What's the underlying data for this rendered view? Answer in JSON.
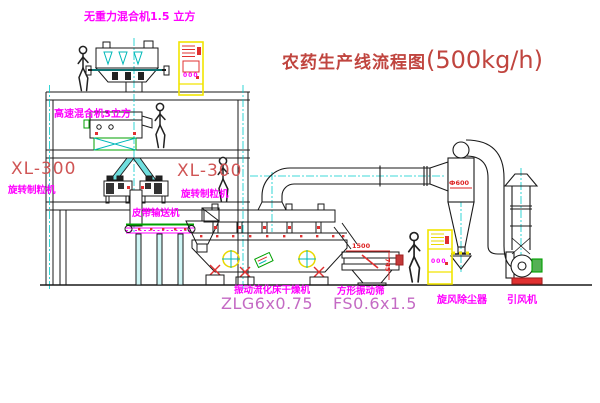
{
  "title": {
    "text": "农药生产线流程图",
    "capacity": "(500kg/h)",
    "color": "#c0453f"
  },
  "equipment_labels": {
    "gravity_mixer": "无重力混合机1.5 立方",
    "highspeed_mixer": "高速混合机3立方",
    "granulator_left_model": "XL-300",
    "granulator_left_name": "旋转制粒机",
    "granulator_right_model": "XL-300",
    "granulator_right_name": "旋转制粒机",
    "belt_conveyor": "皮带输送机",
    "fluid_bed_dryer": "振动流化床干燥机",
    "fluid_bed_dryer_model": "ZLG6x0.75",
    "vibrating_screen": "方形振动筛",
    "vibrating_screen_model": "FS0.6x1.5",
    "cyclone": "旋风除尘器",
    "induced_draft_fan": "引风机"
  },
  "dimensions": {
    "screen_length": "1500",
    "screen_height": "745",
    "cyclone_diameter": "Ф600"
  },
  "control_cabinets": [
    {
      "mark": "000"
    },
    {
      "mark": "000"
    }
  ],
  "colors": {
    "label_magenta": "#ff00ff",
    "model_red": "#d05555",
    "model_pink": "#c46ac4",
    "dimension_red": "#dd2222",
    "centerline_cyan": "#00cccc",
    "cabinet_yellow": "#f2e400",
    "line_black": "#1a1a1a",
    "belt_green": "#00a000",
    "spring_red": "#e03030"
  }
}
